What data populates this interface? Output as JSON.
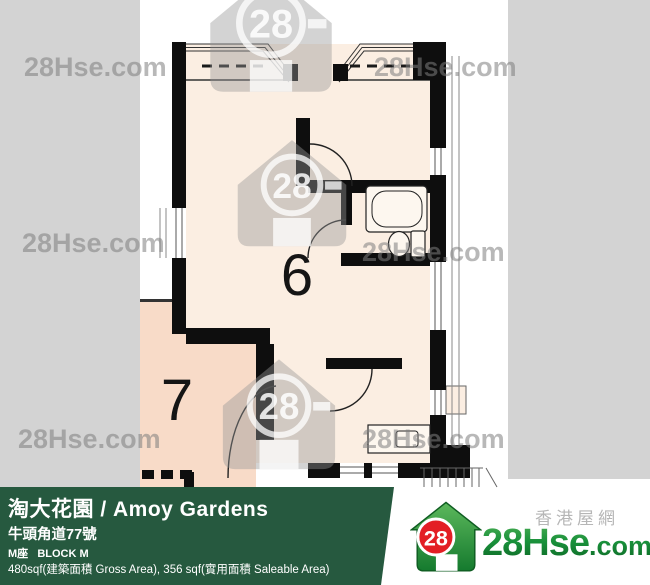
{
  "floor_plan": {
    "unit6_label": "6",
    "unit7_label": "7"
  },
  "watermarks": {
    "site_text": "28Hse.com",
    "logo_number": "28"
  },
  "banner": {
    "title": "淘大花園 / Amoy Gardens",
    "address": "牛頭角道77號",
    "block": "M座   BLOCK M",
    "area_info": "480sqf(建築面積 Gross Area), 356 sqf(實用面積 Saleable Area)",
    "bg_color": "#26593F"
  },
  "site_logo": {
    "circle_number": "28",
    "name_main": "28Hse",
    "name_suffix": ".com",
    "tagline": "香港屋網",
    "brand_green": "#1E7F35",
    "brand_red": "#E31E24"
  },
  "colors": {
    "background_gray": "#D3D3D3",
    "room_cream": "#FBEEE2",
    "room_pink": "#F8DBC8",
    "wall_black": "#0E0E0E",
    "watermark_gray": "#7D7D7D"
  }
}
